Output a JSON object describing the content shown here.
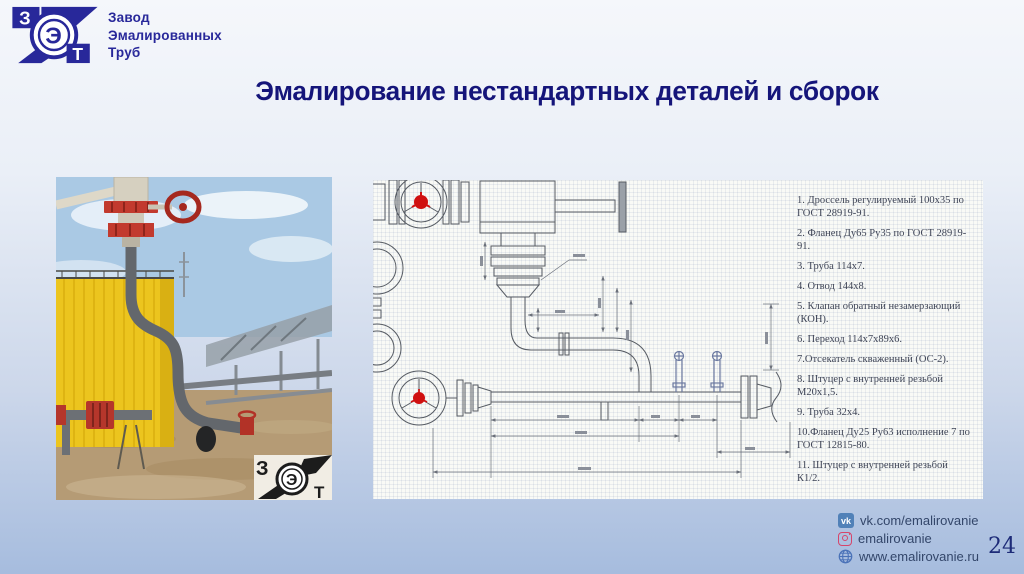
{
  "slide": {
    "title": "Эмалирование нестандартных деталей и сборок",
    "page_number": "24"
  },
  "logo": {
    "letter_z": "З",
    "letter_e": "Э",
    "letter_t": "Т",
    "company_name_lines": [
      "Завод",
      "Эмалированных",
      "Труб"
    ]
  },
  "photo_watermark": {
    "letter_z": "З",
    "letter_e": "Э",
    "letter_t": "Т"
  },
  "parts_list": {
    "items": [
      "1. Дроссель регулируемый 100х35 по ГОСТ 28919-91.",
      "2. Фланец Ду65 Ру35 по ГОСТ 28919-91.",
      "3. Труба 114х7.",
      "4. Отвод 144х8.",
      "5. Клапан обратный незамерзающий (КОН).",
      "6. Переход 114х7х89х6.",
      "7.Отсекатель скваженный (ОС-2).",
      "8. Штуцер с внутренней резьбой М20х1,5.",
      "9. Труба 32х4.",
      "10.Фланец Ду25 Ру63 исполнение 7 по ГОСТ 12815-80.",
      "11. Штуцер с внутренней резьбой К1/2."
    ]
  },
  "footer_links": [
    {
      "icon": "vk",
      "icon_text": "vk",
      "label": "vk.com/emalirovanie"
    },
    {
      "icon": "instagram",
      "label": "emalirovanie"
    },
    {
      "icon": "globe",
      "label": "www.emalirovanie.ru"
    }
  ],
  "colors": {
    "accent_navy": "#15157a",
    "logo_navy": "#28289a",
    "vk_blue": "#5181b8",
    "instagram_pink": "#d6456b",
    "globe_blue": "#4a72b8",
    "valve_red": "#d01010"
  }
}
